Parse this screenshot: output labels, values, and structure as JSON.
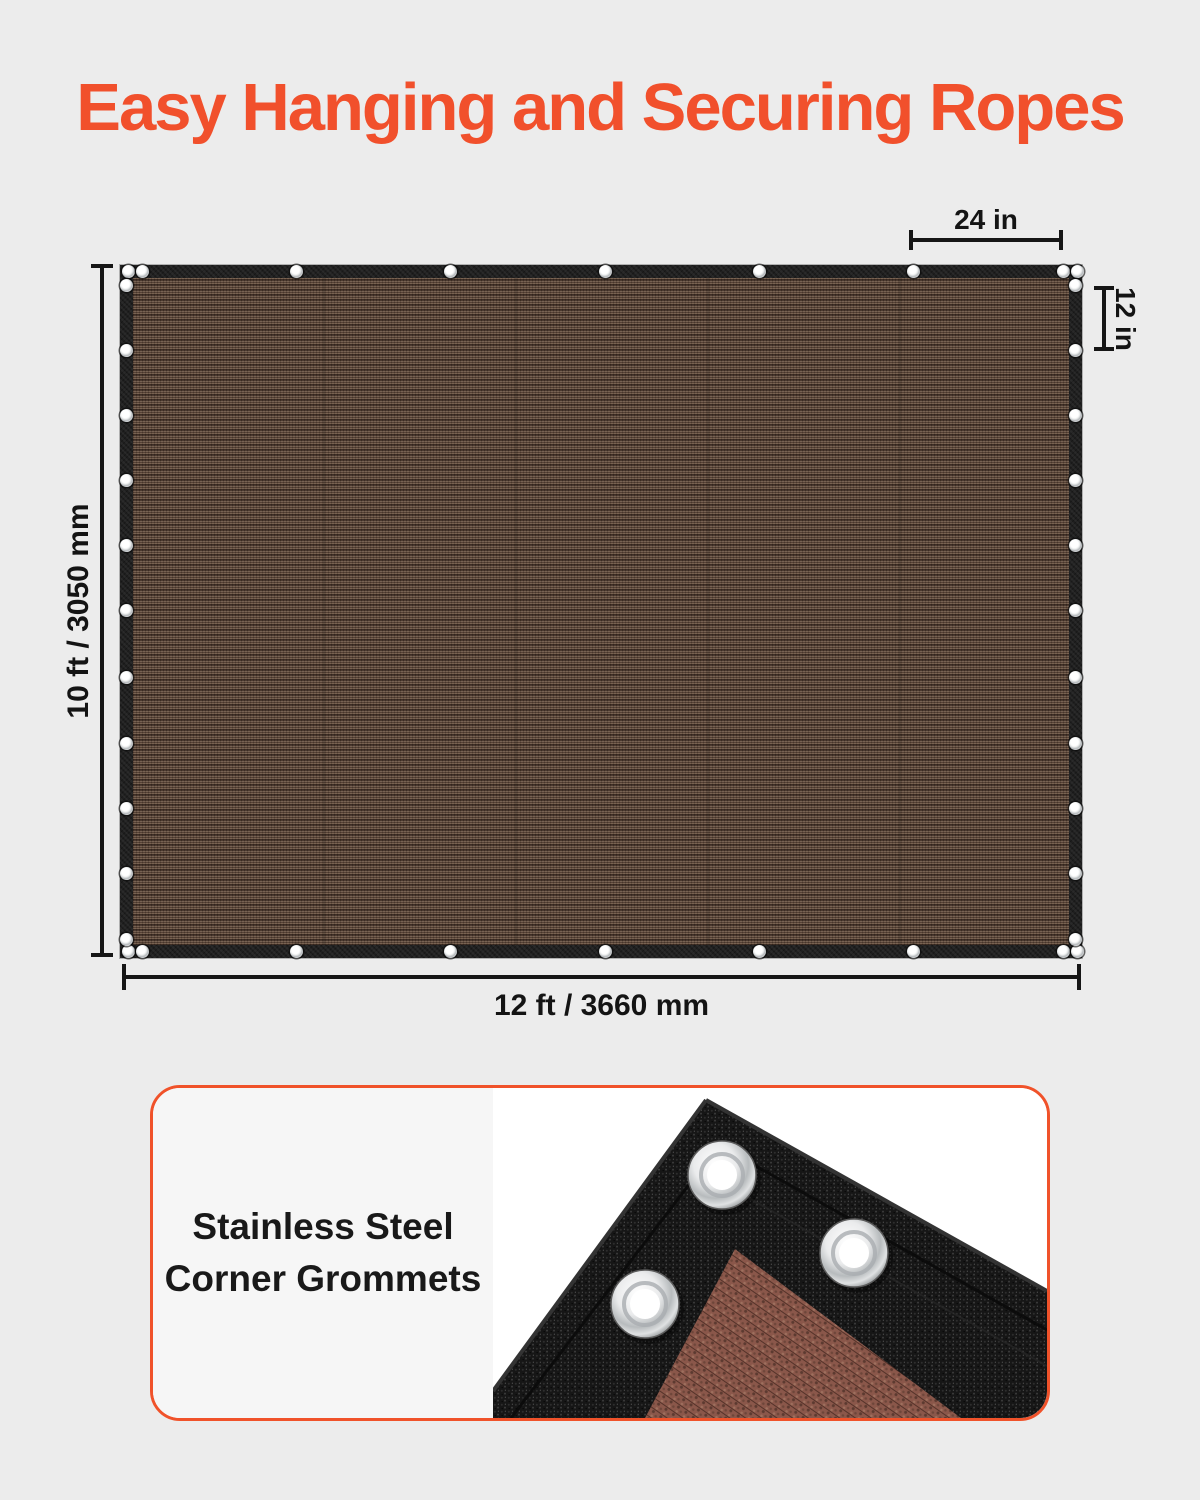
{
  "page": {
    "background_color": "#ECECEC"
  },
  "title": {
    "text": "Easy Hanging and Securing Ropes",
    "color": "#F1502C"
  },
  "diagram": {
    "height_label": "10 ft / 3050 mm",
    "width_label": "12 ft / 3660 mm",
    "top_grommet_spacing_label": "24 in",
    "side_grommet_spacing_label": "12 in",
    "fabric_color": "#5E4A3D",
    "border_color": "#1F1F1F",
    "dimension_line_color": "#161616",
    "grommets": {
      "top_edge_x": [
        8,
        22,
        176,
        330,
        485,
        639,
        793,
        943,
        957
      ],
      "side_edge_y": [
        20,
        85,
        150,
        215,
        280,
        345,
        412,
        478,
        543,
        608,
        674
      ]
    }
  },
  "card": {
    "border_color": "#F0522A",
    "caption_line1": "Stainless Steel",
    "caption_line2": "Corner Grommets"
  }
}
